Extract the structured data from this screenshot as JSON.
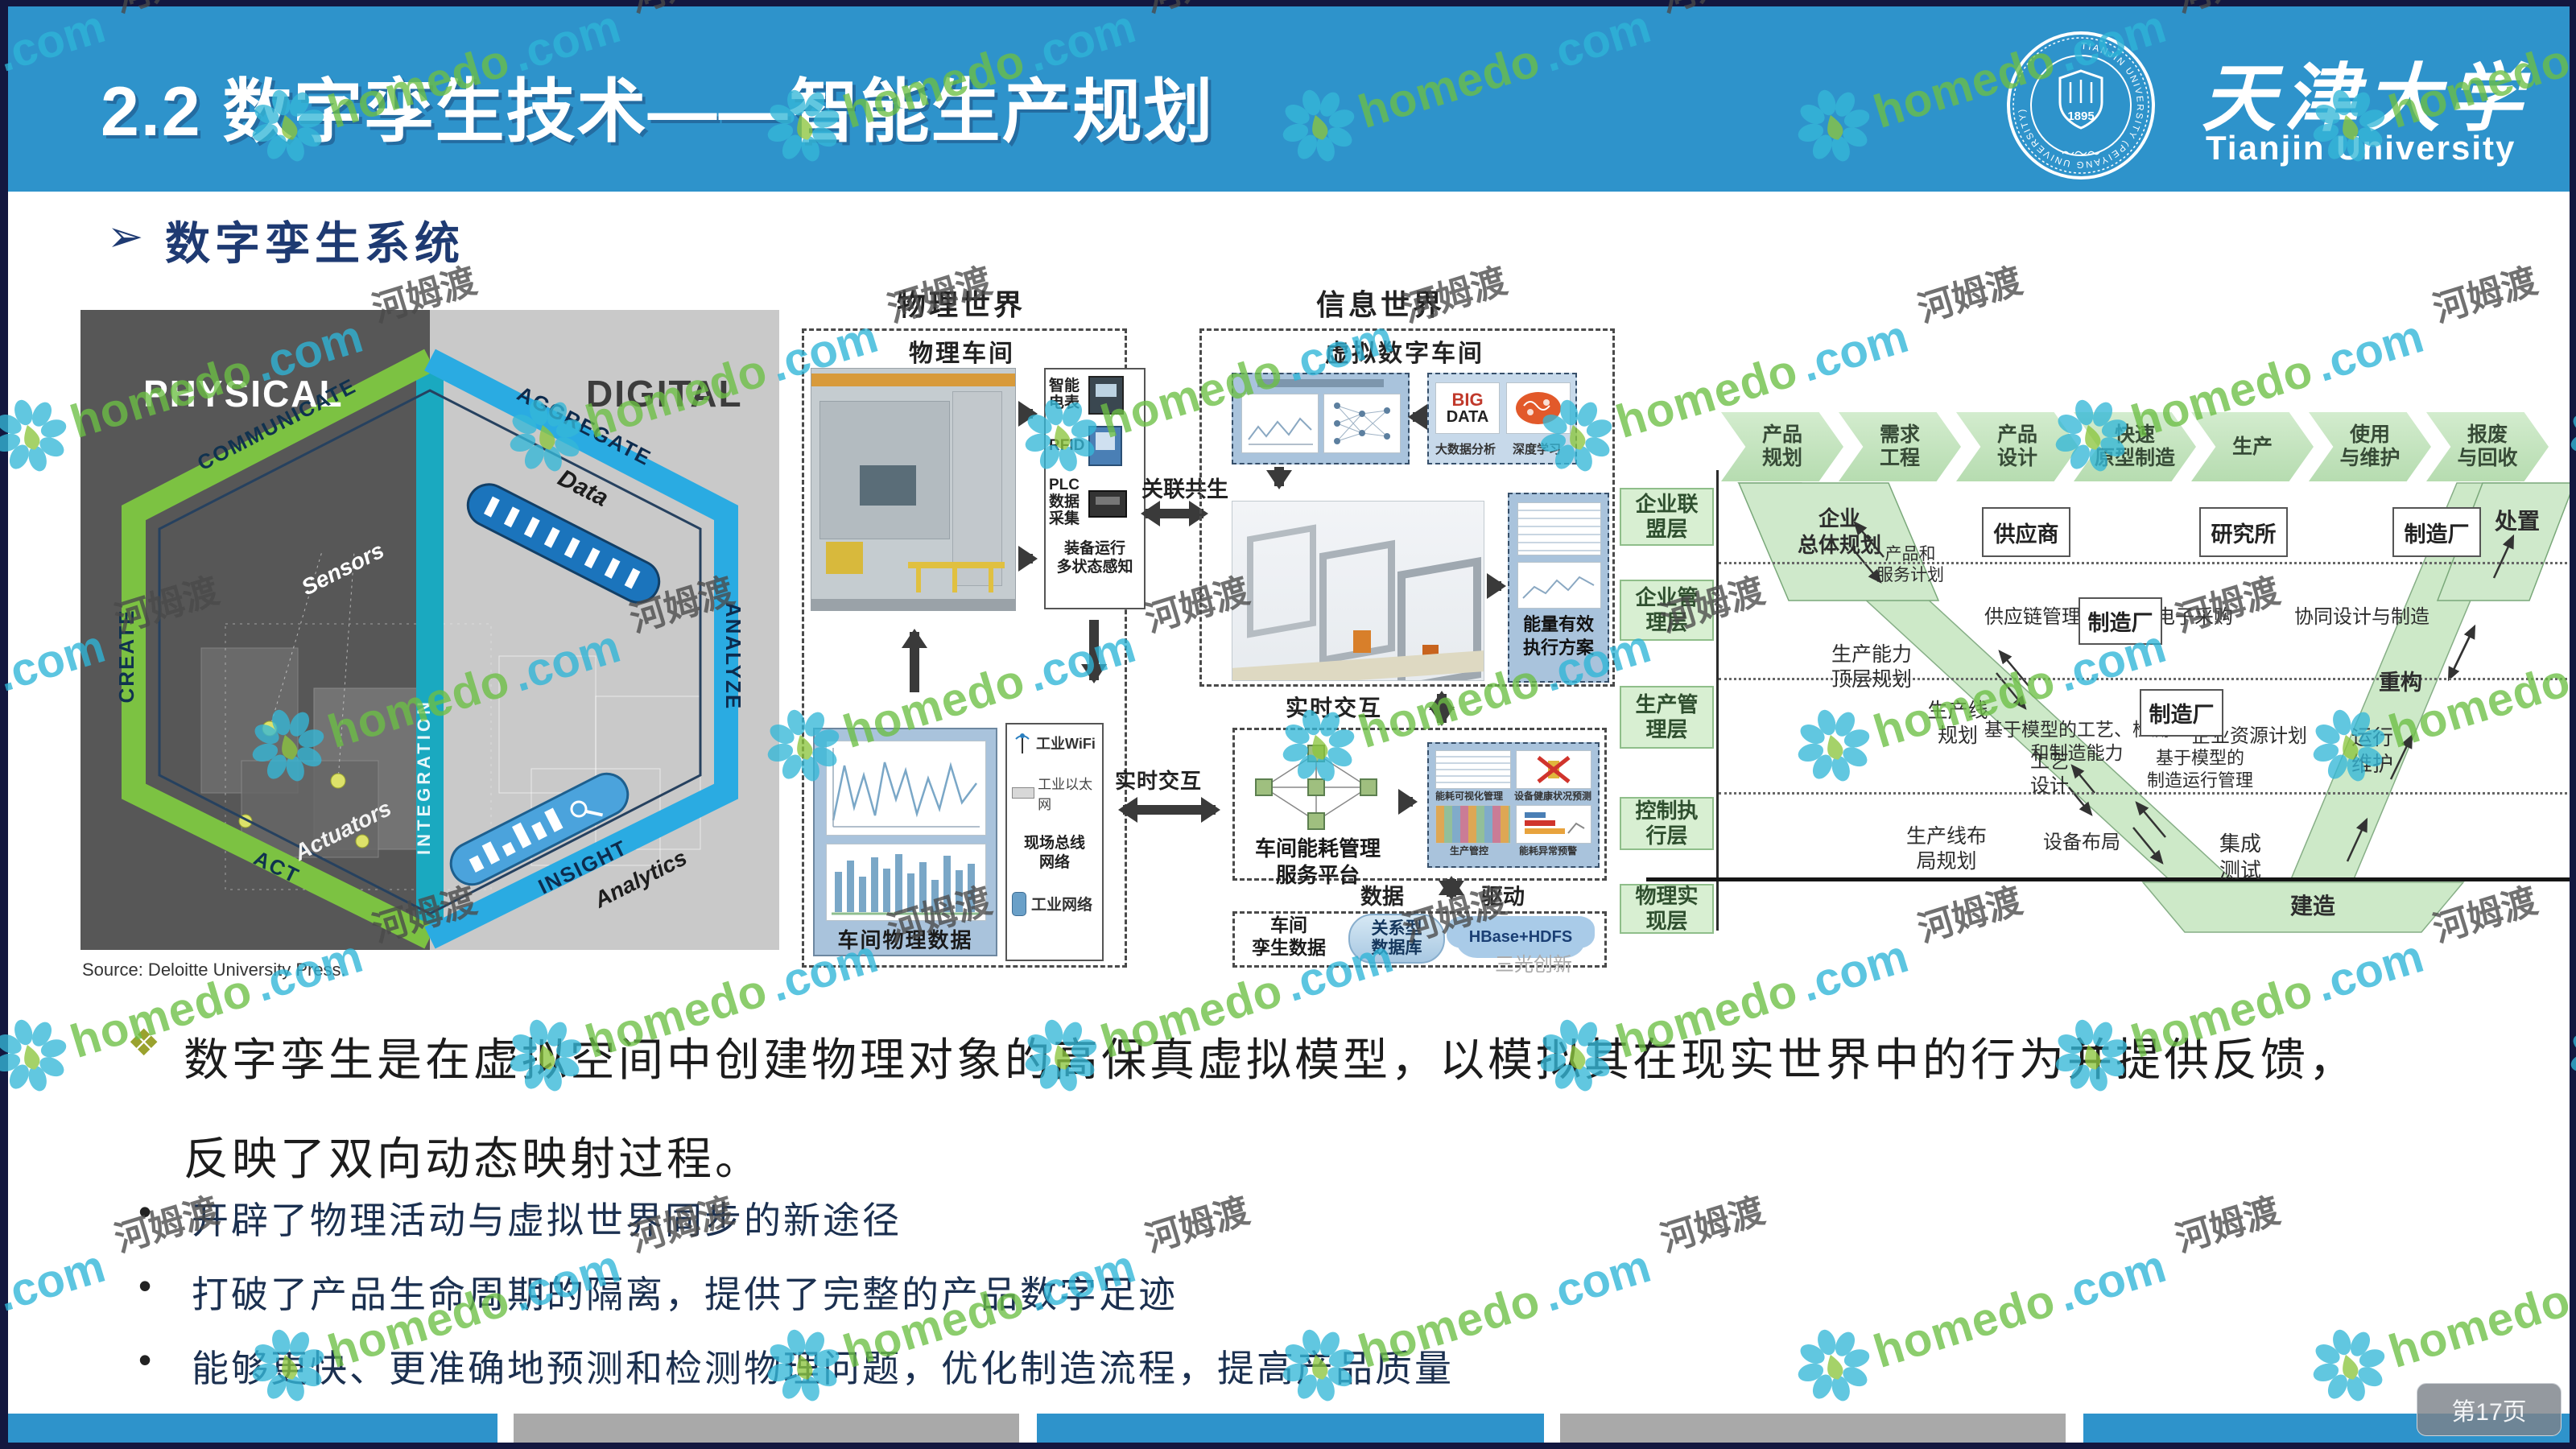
{
  "header": {
    "title": "2.2 数字孪生技术——智能生产规划",
    "logo": {
      "seal_ring_text": "TIANJIN UNIVERSITY (PEIYANG UNIVERSITY)",
      "seal_year": "1895",
      "name_cn": "天津大学",
      "name_en": "Tianjin University"
    }
  },
  "section": {
    "heading": "数字孪生系统",
    "arrow_glyph": "➢"
  },
  "hex_figure": {
    "physical": "PHYSICAL",
    "digital": "DIGITAL",
    "create": "CREATE",
    "communicate": "COMMUNICATE",
    "aggregate": "AGGREGATE",
    "analyze": "ANALYZE",
    "act": "ACT",
    "insight": "INSIGHT",
    "sensors": "Sensors",
    "data": "Data",
    "integration": "INTEGRATION",
    "actuators": "Actuators",
    "analytics": "Analytics",
    "source": "Source: Deloitte University Press."
  },
  "flow_figure": {
    "world_left": "物理世界",
    "world_right": "信息世界",
    "shop_left": "物理车间",
    "shop_right": "虚拟数字车间",
    "meter": "智能电表",
    "rfid": "RFID",
    "plc": "PLC\n数据\n采集",
    "sensing_caption": "装备运行\n多状态感知",
    "link_label": "关联共生",
    "big": "BIG",
    "data_word": "DATA",
    "bigdata_cap1": "大数据分析",
    "bigdata_cap2": "深度学习",
    "energy_plan": "能量有效\n执行方案",
    "realtime_v": "实时交互",
    "realtime_h": "实时交互",
    "phys_data_caption": "车间物理数据",
    "net_wifi": "工业WiFi",
    "net_ethernet": "工业以太网",
    "net_fieldbus": "现场总线\n网络",
    "net_caption": "工业网络",
    "platform_caption": "车间能耗管理\n服务平台",
    "thumb1": "能耗可视化管理",
    "thumb2": "设备健康状况预测",
    "thumb3": "生产管控",
    "thumb4": "能耗异常预警",
    "data_label": "数据",
    "drive_label": "驱动",
    "twin_caption": "车间\n孪生数据",
    "rel_db": "关系型\n数据库",
    "hdfs": "HBase+HDFS",
    "brand_mark": "三光创新"
  },
  "vmodel": {
    "chevrons": [
      "产品\n规划",
      "需求\n工程",
      "产品\n设计",
      "快速\n原型制造",
      "生产",
      "使用\n与维护",
      "报废\n与回收"
    ],
    "layers": [
      "企业联\n盟层",
      "企业管\n理层",
      "生产管\n理层",
      "控制执\n行层",
      "物理实\n现层"
    ],
    "overall": "企业\n总体规划",
    "psp": "产品和\n服务计划",
    "supplier": "供应商",
    "institute": "研究所",
    "factory": "制造厂",
    "scm": "供应链管理",
    "eproc": "电子采购",
    "collab": "协同设计与制造",
    "dispose": "处置",
    "capacity": "生产能力\n顶层规划",
    "model_cap": "基于模型的工艺、检测\n和制造能力",
    "erp": "企业资源计划",
    "rebuild": "重构",
    "line_plan": "生产线\n规划",
    "process_design": "工艺\n设计",
    "mom": "基于模型的\n制造运行管理",
    "om": "运行\n维护",
    "layout_plan": "生产线布\n局规划",
    "equip_layout": "设备布局",
    "int_test": "集成\n测试",
    "build": "建造"
  },
  "body": {
    "paragraph": "数字孪生是在虚拟空间中创建物理对象的高保真虚拟模型，以模拟其在现实世界中的行为并提供反馈，反映了双向动态映射过程。",
    "bullets": [
      "开辟了物理活动与虚拟世界同步的新途径",
      "打破了产品生命周期的隔离，提供了完整的产品数字足迹",
      "能够更快、更准确地预测和检测物理问题，优化制造流程，提高产品质量"
    ]
  },
  "footer": {
    "page_badge": "第17页"
  },
  "watermark": {
    "brand": "homedo",
    "tld": ".com",
    "cn": "河姆渡"
  },
  "colors": {
    "header_blue": "#2e93cb",
    "border_navy": "#13173f",
    "accent_navy": "#1e3a72",
    "panel_blue": "#a9c3dc",
    "green_fill": "#cde9c8",
    "hex_green": "#7cc242",
    "hex_blue": "#2aabe2",
    "watermark_green": "#6cbf45",
    "watermark_cyan": "#2fb5d8"
  }
}
